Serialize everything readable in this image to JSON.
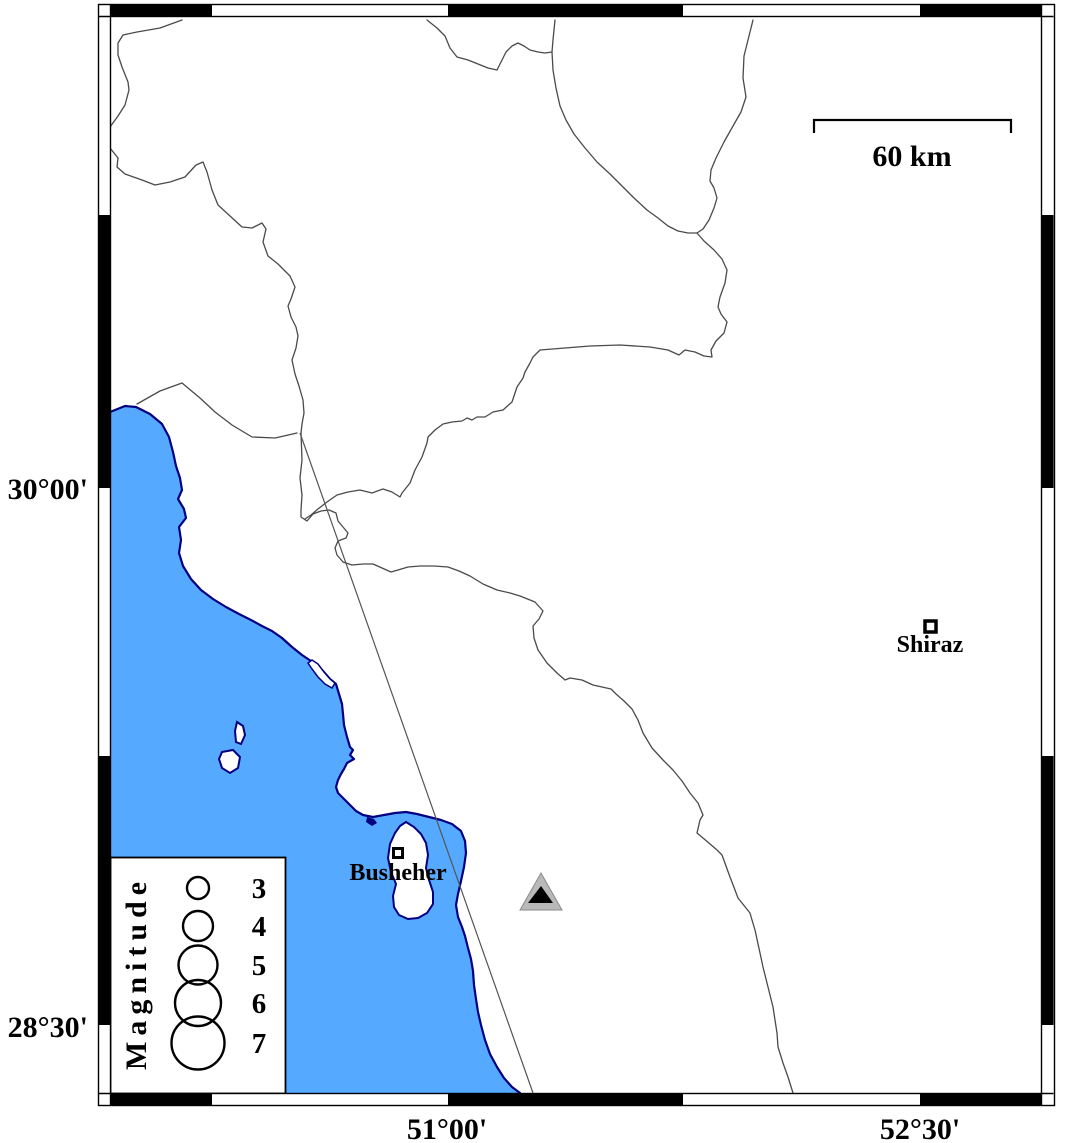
{
  "map": {
    "lat_labels": [
      "30°00'",
      "28°30'"
    ],
    "lon_labels": [
      "51°00'",
      "52°30'"
    ],
    "scale_bar": {
      "label": "60 km"
    },
    "cities": {
      "busheher": "Busheher",
      "shiraz": "Shiraz"
    },
    "legend": {
      "title": "Magnitude",
      "values": [
        "3",
        "4",
        "5",
        "6",
        "7"
      ]
    },
    "colors": {
      "sea": "#55aaff",
      "coastline": "#000080",
      "boundary": "#4a4a4a",
      "fault_line": "#555555",
      "frame_black": "#000000",
      "triangle_gray": "#b9b9b9",
      "triangle_black": "#000000"
    }
  }
}
